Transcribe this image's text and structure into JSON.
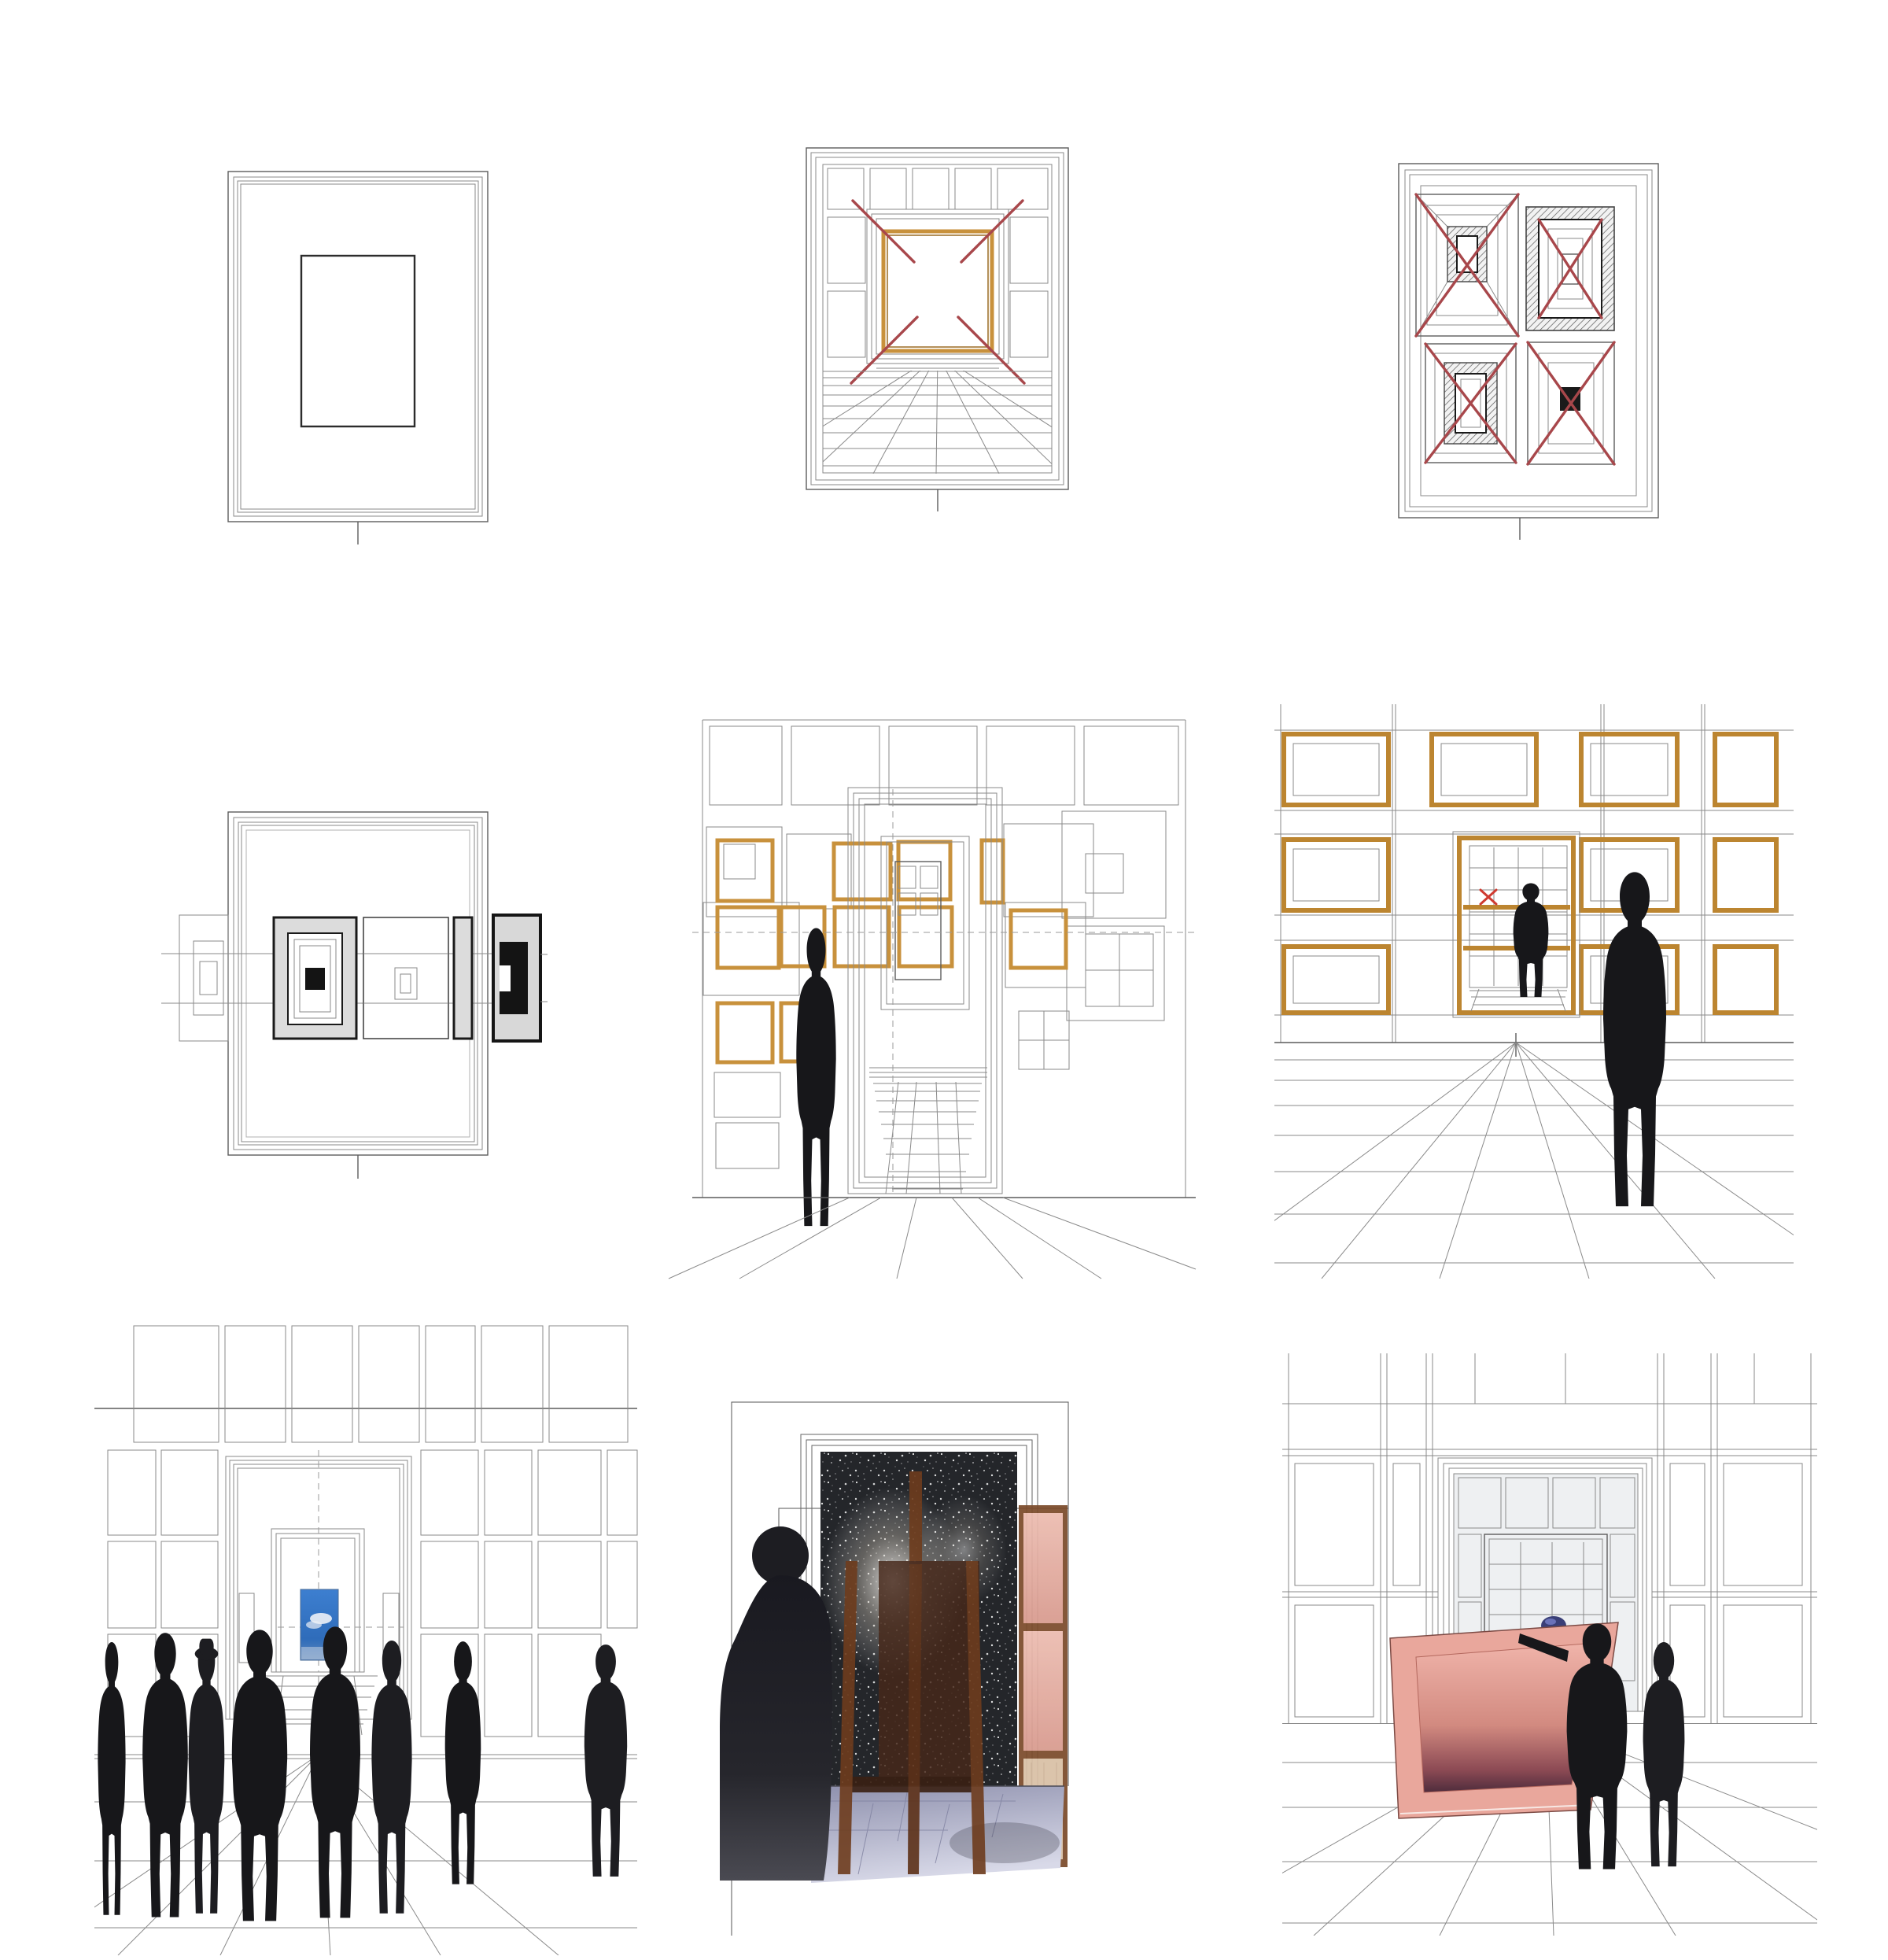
{
  "page": {
    "title": "Nine-panel architectural study board: gallery frames, perspectives and silhouetted visitors",
    "background": "#ffffff",
    "grid": {
      "rows": 3,
      "columns": 3
    },
    "total_silhouettes": 14
  },
  "palette": {
    "sketch_line": "#8a8a8a",
    "dark_line": "#2c2c2c",
    "gold_frame": "#c8913c",
    "maroon_diagonal": "#a8474b",
    "bright_red_x": "#cf3a30",
    "silhouette_black": "#17171a",
    "panel_gray": "#dcdcdc",
    "sky_blue": "#3272c4",
    "cloud_white": "#e9eef5",
    "night_sky": "#24262a",
    "easel_wood": "#6e3c1d",
    "cabinet_pink": "#e0a99e",
    "painting_pink": "#e9a79c",
    "painting_shadow": "#4e2c3c",
    "floor_lilac": "#a7a8c0"
  },
  "panels": [
    {
      "id": "frame-elevation",
      "row": 1,
      "col": 1,
      "figures": 0,
      "description": "Line elevation of an empty multi-profile frame enclosing a small dark rectangle, with a centre hanging tick below"
    },
    {
      "id": "perspective-gold-frame",
      "row": 1,
      "col": 2,
      "figures": 0,
      "description": "One-point perspective of a panelled gallery wall with a central gold frame, red corner diagonals and a tiled floor"
    },
    {
      "id": "four-frame-studies",
      "row": 1,
      "col": 3,
      "figures": 0,
      "description": "Four nested frame studies with hatched borders and a black core, each crossed out with red diagonals"
    },
    {
      "id": "elevation-frame-band",
      "row": 2,
      "col": 1,
      "figures": 0,
      "description": "Frame elevation crossed by a horizontal band of overlapping outline, grey, white and black panels extending beyond both edges"
    },
    {
      "id": "gallery-lone-visitor",
      "row": 2,
      "col": 2,
      "figures": 1,
      "description": "Perspective of a frame-covered gallery wall with gold frames, dashed axes, corridor doorway and one silhouetted visitor"
    },
    {
      "id": "gallery-two-visitors",
      "row": 2,
      "col": 3,
      "figures": 2,
      "description": "Gallery hung with empty gold frames, a red X on the far wall, a visitor in the doorway and a large foreground silhouette"
    },
    {
      "id": "crowd-blue-painting",
      "row": 3,
      "col": 1,
      "figures": 8,
      "description": "Crowd of silhouetted visitors gathered before a small blue sky painting seen through a panelled doorway"
    },
    {
      "id": "easel-starry-night",
      "row": 3,
      "col": 2,
      "figures": 1,
      "description": "Silhouetted figure contemplating a starry night image behind a wooden easel, beside a pink-panelled cabinet on a lilac tiled floor"
    },
    {
      "id": "carrying-pink-painting",
      "row": 3,
      "col": 3,
      "figures": 2,
      "description": "Two silhouetted handlers moving a large tilted pink framed painting across a panelled gallery with tiled floor"
    }
  ]
}
